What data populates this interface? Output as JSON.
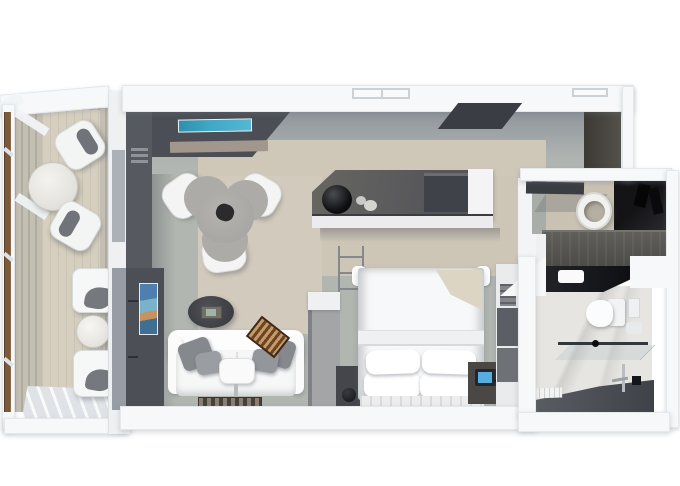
{
  "title": "suite-floor-plan-render",
  "view": "top-down-3d",
  "palette": {
    "wall": "#f6f8f9",
    "floor": "#b2b6b1",
    "rug": "#d2cabc",
    "deck": "#c4bfb3",
    "deckmat": "#d6cfbf",
    "dark": "#4c4f55",
    "wood": "#7a5a3c",
    "credenza": "#55555a",
    "tvblue": "#3fa6c4",
    "scrblue": "#57aede",
    "marble": "#e7e5e1",
    "counter": "#0e0f12",
    "shower": "#3f4248",
    "sofa": "#f6f7f7",
    "pillow": "#85888d",
    "bg-brown": "#6b4426",
    "blanket": "#dcd5c4"
  },
  "scene": {
    "rooms": [
      {
        "name": "balcony",
        "furniture": [
          "round-marble-table",
          "balcony-chair",
          "balcony-chair",
          "club-chair",
          "round-side-table",
          "club-chair",
          "wood-handrail",
          "teak-deck"
        ]
      },
      {
        "name": "living-room",
        "furniture": [
          "media-console",
          "wall-tv",
          "tri-lobe-dining-table",
          "dining-chair",
          "dining-chair",
          "dining-chair",
          "sofa",
          "throw-pillows",
          "ottoman-tray-table",
          "oval-coffee-table",
          "backgammon-board",
          "patterned-rug",
          "tv-art-panel"
        ]
      },
      {
        "name": "wet-bar",
        "furniture": [
          "credenza",
          "ice-bucket",
          "glassware",
          "minibar-cabinet"
        ]
      },
      {
        "name": "bedroom",
        "furniture": [
          "double-bed",
          "bed-pillows",
          "folded-blanket",
          "nightstand",
          "nightstand",
          "phone-dock",
          "table-lamp",
          "striped-runner-rug",
          "wardrobe-unit",
          "glass-railing-partition"
        ]
      },
      {
        "name": "entry-hall",
        "furniture": [
          "wardrobe-cabinet"
        ]
      },
      {
        "name": "dressing-room",
        "furniture": [
          "vessel-sink",
          "open-closet",
          "long-dresser",
          "wall-shelf"
        ]
      },
      {
        "name": "bathroom",
        "furniture": [
          "black-vanity-counter",
          "sink-basin",
          "toilet",
          "flush-plate",
          "towel-holder",
          "glass-shower-screen",
          "shower-fixture",
          "bath-mat",
          "marble-floor"
        ]
      }
    ]
  }
}
